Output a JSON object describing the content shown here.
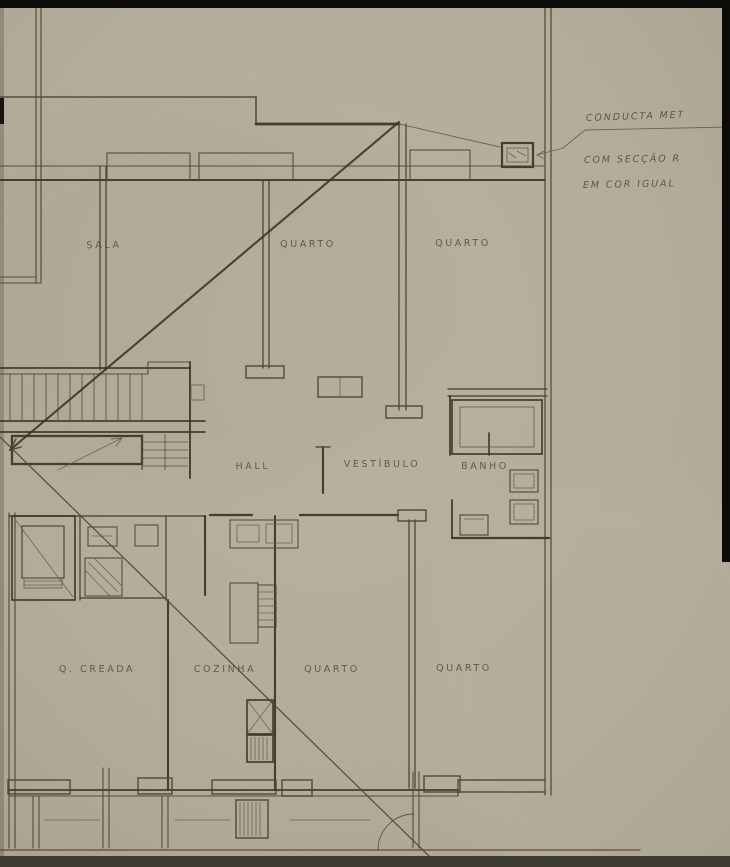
{
  "drawing": {
    "type": "architectural-floor-plan",
    "palette": {
      "paper": "#b2ab99",
      "paper_light": "#b9b2a1",
      "ink_dark": "#41331f",
      "ink": "#55452e",
      "ink_light": "#6d5b42",
      "edge_black": "#0c0b09",
      "bottom_bar": "#3f3c36"
    },
    "rooms": [
      {
        "label": "SALA",
        "x": 104,
        "y": 248,
        "r": -1
      },
      {
        "label": "QUARTO",
        "x": 308,
        "y": 247,
        "r": 0
      },
      {
        "label": "QUARTO",
        "x": 463,
        "y": 246,
        "r": 0
      },
      {
        "label": "HALL",
        "x": 253,
        "y": 469,
        "r": -1
      },
      {
        "label": "VESTÍBULO",
        "x": 382,
        "y": 467,
        "r": 0
      },
      {
        "label": "BANHO",
        "x": 485,
        "y": 469,
        "r": 0
      },
      {
        "label": "Q. CREADA",
        "x": 97,
        "y": 672,
        "r": 0
      },
      {
        "label": "COZINHA",
        "x": 225,
        "y": 672,
        "r": 0
      },
      {
        "label": "QUARTO",
        "x": 332,
        "y": 672,
        "r": 0
      },
      {
        "label": "QUARTO",
        "x": 464,
        "y": 671,
        "r": 0
      }
    ],
    "annotations": [
      {
        "text": "CONDUCTA MET",
        "x": 586,
        "y": 121,
        "r": -2
      },
      {
        "text": "COM SECÇÃO R",
        "x": 584,
        "y": 163,
        "r": -1
      },
      {
        "text": "EM COR IGUAL",
        "x": 583,
        "y": 188,
        "r": -1
      }
    ],
    "geometry": {
      "walls": [
        [
          36,
          8,
          36,
          283,
          1.2
        ],
        [
          41,
          8,
          41,
          283,
          1.2
        ],
        [
          0,
          97,
          256,
          97,
          1.6
        ],
        [
          256,
          97,
          256,
          124,
          1.6
        ],
        [
          256,
          124,
          399,
          124,
          2.8
        ],
        [
          0,
          166,
          545,
          166,
          1.1
        ],
        [
          0,
          180,
          545,
          180,
          1.9
        ],
        [
          399,
          124,
          399,
          410,
          1.4
        ],
        [
          406,
          124,
          406,
          410,
          1.4
        ],
        [
          263,
          180,
          263,
          368,
          1.4
        ],
        [
          269,
          180,
          269,
          368,
          1.4
        ],
        [
          545,
          8,
          545,
          795,
          1.3
        ],
        [
          551,
          8,
          551,
          795,
          1.3
        ],
        [
          0,
          277,
          36,
          277,
          1.1
        ],
        [
          0,
          283,
          41,
          283,
          1.1
        ],
        [
          100,
          166,
          100,
          370,
          1.4
        ],
        [
          106,
          166,
          106,
          370,
          1.4
        ],
        [
          0,
          368,
          190,
          368,
          1.7
        ],
        [
          0,
          374,
          148,
          374,
          1.1
        ],
        [
          148,
          374,
          148,
          362,
          1.1
        ],
        [
          148,
          362,
          190,
          362,
          1.1
        ],
        [
          190,
          362,
          190,
          478,
          1.9
        ],
        [
          0,
          421,
          205,
          421,
          1.7
        ],
        [
          0,
          432,
          205,
          432,
          1.7
        ],
        [
          210,
          515,
          252,
          515,
          2.3
        ],
        [
          300,
          515,
          398,
          515,
          2.3
        ],
        [
          448,
          389,
          547,
          389,
          1.4
        ],
        [
          448,
          396,
          547,
          396,
          1.4
        ],
        [
          450,
          396,
          450,
          455,
          1.8
        ],
        [
          452,
          500,
          452,
          538,
          1.8
        ],
        [
          452,
          538,
          549,
          538,
          2.2
        ],
        [
          489,
          433,
          489,
          455,
          1.7
        ],
        [
          323,
          447,
          323,
          493,
          2.1
        ],
        [
          316,
          447,
          330,
          447,
          1.4
        ],
        [
          9,
          513,
          9,
          848,
          1.2
        ],
        [
          15,
          513,
          15,
          848,
          1.2
        ],
        [
          9,
          516,
          205,
          516,
          1.6
        ],
        [
          80,
          516,
          80,
          600,
          1.4
        ],
        [
          166,
          516,
          166,
          600,
          1.4
        ],
        [
          80,
          598,
          166,
          598,
          1.4
        ],
        [
          205,
          516,
          205,
          595,
          2.1
        ],
        [
          168,
          600,
          168,
          790,
          2.1
        ],
        [
          275,
          516,
          275,
          790,
          2.1
        ],
        [
          409,
          520,
          409,
          788,
          1.4
        ],
        [
          415,
          520,
          415,
          788,
          1.4
        ],
        [
          458,
          780,
          545,
          780,
          1.4
        ],
        [
          458,
          792,
          545,
          792,
          1.4
        ],
        [
          458,
          780,
          458,
          795,
          1.4
        ],
        [
          9,
          790,
          458,
          790,
          1.7
        ],
        [
          9,
          796,
          458,
          796,
          1.1
        ],
        [
          0,
          850,
          640,
          850,
          1.3
        ],
        [
          103,
          768,
          103,
          848,
          1.1
        ],
        [
          109,
          768,
          109,
          848,
          1.1
        ],
        [
          162,
          796,
          162,
          848,
          1.1
        ],
        [
          168,
          796,
          168,
          848,
          1.1
        ],
        [
          413,
          772,
          413,
          848,
          1.1
        ],
        [
          419,
          772,
          419,
          848,
          1.1
        ],
        [
          33,
          796,
          33,
          848,
          1.1
        ],
        [
          39,
          796,
          39,
          848,
          1.1
        ],
        [
          45,
          820,
          100,
          820,
          0.8
        ],
        [
          175,
          820,
          230,
          820,
          0.8
        ],
        [
          290,
          820,
          370,
          820,
          0.8
        ],
        [
          399,
          124,
          500,
          147,
          0.9
        ]
      ],
      "rects": [
        {
          "x": 107,
          "y": 153,
          "w": 83,
          "h": 27,
          "sw": 1.1,
          "n": "window-bay"
        },
        {
          "x": 199,
          "y": 153,
          "w": 94,
          "h": 27,
          "sw": 1.1,
          "n": "window-bay"
        },
        {
          "x": 410,
          "y": 150,
          "w": 60,
          "h": 30,
          "sw": 1.1,
          "n": "window-bay"
        },
        {
          "x": 502,
          "y": 143,
          "w": 31,
          "h": 24,
          "sw": 2.2,
          "n": "duct-symbol"
        },
        {
          "x": 507,
          "y": 148,
          "w": 21,
          "h": 14,
          "sw": 0.9,
          "n": "duct-symbol-inner"
        },
        {
          "x": 246,
          "y": 366,
          "w": 38,
          "h": 12,
          "sw": 1.5,
          "n": "wall-end-cap"
        },
        {
          "x": 386,
          "y": 406,
          "w": 36,
          "h": 12,
          "sw": 1.5,
          "n": "wall-end-cap"
        },
        {
          "x": 398,
          "y": 510,
          "w": 28,
          "h": 11,
          "sw": 1.5,
          "n": "wall-end-cap"
        },
        {
          "x": 318,
          "y": 377,
          "w": 44,
          "h": 20,
          "sw": 1.5,
          "n": "hall-window"
        },
        {
          "x": 12,
          "y": 436,
          "w": 130,
          "h": 28,
          "sw": 2.3,
          "n": "stair-landing"
        },
        {
          "x": 12,
          "y": 516,
          "w": 63,
          "h": 84,
          "sw": 1.7,
          "n": "elevator-shaft"
        },
        {
          "x": 22,
          "y": 526,
          "w": 42,
          "h": 52,
          "sw": 1.3,
          "n": "elevator-car"
        },
        {
          "x": 24,
          "y": 578,
          "w": 38,
          "h": 10,
          "sw": 0.9,
          "n": "elevator-sill"
        },
        {
          "x": 88,
          "y": 527,
          "w": 29,
          "h": 19,
          "sw": 1.1,
          "n": "bath-fixture"
        },
        {
          "x": 135,
          "y": 525,
          "w": 23,
          "h": 21,
          "sw": 1.1,
          "n": "bath-fixture"
        },
        {
          "x": 85,
          "y": 558,
          "w": 37,
          "h": 38,
          "sw": 1.1,
          "n": "shower-tray"
        },
        {
          "x": 230,
          "y": 520,
          "w": 68,
          "h": 28,
          "sw": 1.1,
          "n": "kitchen-counter"
        },
        {
          "x": 237,
          "y": 525,
          "w": 22,
          "h": 17,
          "sw": 0.8,
          "n": "kitchen-sink"
        },
        {
          "x": 266,
          "y": 524,
          "w": 26,
          "h": 19,
          "sw": 0.8,
          "n": "kitchen-sink"
        },
        {
          "x": 230,
          "y": 583,
          "w": 28,
          "h": 60,
          "sw": 1.1,
          "n": "kitchen-cabinet"
        },
        {
          "x": 258,
          "y": 585,
          "w": 18,
          "h": 42,
          "sw": 1.1,
          "n": "kitchen-shelves"
        },
        {
          "x": 247,
          "y": 700,
          "w": 26,
          "h": 34,
          "sw": 1.7,
          "n": "dumbwaiter"
        },
        {
          "x": 247,
          "y": 735,
          "w": 26,
          "h": 27,
          "sw": 1.7,
          "n": "flue-hatch"
        },
        {
          "x": 236,
          "y": 800,
          "w": 32,
          "h": 38,
          "sw": 1.5,
          "n": "flue-hatch"
        },
        {
          "x": 452,
          "y": 400,
          "w": 90,
          "h": 54,
          "sw": 1.7,
          "n": "bathtub"
        },
        {
          "x": 460,
          "y": 407,
          "w": 74,
          "h": 40,
          "sw": 0.9,
          "n": "bathtub-inner"
        },
        {
          "x": 510,
          "y": 470,
          "w": 28,
          "h": 22,
          "sw": 1.2,
          "n": "toilet"
        },
        {
          "x": 514,
          "y": 474,
          "w": 20,
          "h": 14,
          "sw": 0.8,
          "n": "toilet-inner"
        },
        {
          "x": 510,
          "y": 500,
          "w": 28,
          "h": 24,
          "sw": 1.2,
          "n": "bidet"
        },
        {
          "x": 514,
          "y": 504,
          "w": 20,
          "h": 16,
          "sw": 0.8,
          "n": "bidet-inner"
        },
        {
          "x": 460,
          "y": 515,
          "w": 28,
          "h": 20,
          "sw": 1.2,
          "n": "washbasin"
        },
        {
          "x": 191,
          "y": 385,
          "w": 13,
          "h": 15,
          "sw": 0.9,
          "n": "stair-door-notch"
        },
        {
          "x": 8,
          "y": 780,
          "w": 62,
          "h": 14,
          "sw": 1.5,
          "n": "pilaster"
        },
        {
          "x": 138,
          "y": 778,
          "w": 34,
          "h": 16,
          "sw": 1.5,
          "n": "pilaster"
        },
        {
          "x": 212,
          "y": 780,
          "w": 64,
          "h": 14,
          "sw": 1.5,
          "n": "pilaster"
        },
        {
          "x": 282,
          "y": 780,
          "w": 30,
          "h": 16,
          "sw": 1.5,
          "n": "pilaster"
        },
        {
          "x": 424,
          "y": 776,
          "w": 36,
          "h": 16,
          "sw": 1.5,
          "n": "pilaster"
        }
      ],
      "details": [
        [
          509,
          153,
          516,
          158
        ],
        [
          517,
          151,
          526,
          156
        ],
        [
          24,
          581,
          62,
          581
        ],
        [
          24,
          585,
          62,
          585
        ],
        [
          88,
          562,
          118,
          592
        ],
        [
          94,
          558,
          122,
          586
        ],
        [
          85,
          570,
          110,
          596
        ],
        [
          92,
          536,
          113,
          536
        ],
        [
          258,
          592,
          276,
          592
        ],
        [
          258,
          599,
          276,
          599
        ],
        [
          258,
          606,
          276,
          606
        ],
        [
          258,
          613,
          276,
          613
        ],
        [
          258,
          620,
          276,
          620
        ],
        [
          247,
          700,
          273,
          734
        ],
        [
          273,
          700,
          247,
          734
        ],
        [
          251,
          737,
          251,
          760
        ],
        [
          255,
          737,
          255,
          760
        ],
        [
          259,
          737,
          259,
          760
        ],
        [
          263,
          737,
          263,
          760
        ],
        [
          267,
          737,
          267,
          760
        ],
        [
          240,
          802,
          240,
          836
        ],
        [
          244,
          802,
          244,
          836
        ],
        [
          248,
          802,
          248,
          836
        ],
        [
          252,
          802,
          252,
          836
        ],
        [
          256,
          802,
          256,
          836
        ],
        [
          260,
          802,
          260,
          836
        ],
        [
          464,
          519,
          484,
          519
        ],
        [
          340,
          377,
          340,
          397
        ],
        [
          14,
          518,
          73,
          597
        ]
      ],
      "stairs": {
        "tread_x_start": 10,
        "tread_x_end": 142,
        "tread_step": 12,
        "tread_y_top": 374,
        "tread_y_bottom": 420,
        "return_treads_y": [
          442,
          450,
          458,
          466
        ],
        "return_x_start": 142,
        "return_x_end": 188,
        "return_verticals": [
          [
            142,
            434,
            142,
            470,
            1.3
          ],
          [
            165,
            434,
            165,
            470,
            0.85
          ]
        ]
      },
      "polylines": [
        {
          "pts": [
            [
              399,
              122
            ],
            [
              10,
              450
            ]
          ],
          "w": 2.1,
          "n": "plan-diagonal"
        },
        {
          "pts": [
            [
              0,
              437
            ],
            [
              430,
              857
            ]
          ],
          "w": 1.3,
          "n": "plan-diagonal"
        },
        {
          "pts": [
            [
              58,
              470
            ],
            [
              122,
              438
            ]
          ],
          "w": 0.9,
          "n": "stair-direction-arrow"
        },
        {
          "pts": [
            [
              21,
              447
            ],
            [
              10,
              450
            ],
            [
              16,
              439
            ]
          ],
          "w": 1.6,
          "n": "arrowhead"
        },
        {
          "pts": [
            [
              111,
              439
            ],
            [
              122,
              438
            ],
            [
              116,
              446
            ]
          ],
          "w": 0.9,
          "n": "arrowhead"
        },
        {
          "pts": [
            [
              537,
              155
            ],
            [
              563,
              148
            ],
            [
              585,
              130
            ],
            [
              729,
              127
            ]
          ],
          "w": 0.9,
          "n": "annotation-leader"
        },
        {
          "pts": [
            [
              544,
              151
            ],
            [
              537,
              155
            ],
            [
              545,
              159
            ]
          ],
          "w": 0.9,
          "n": "annotation-leader-arrow"
        }
      ],
      "paths": [
        {
          "d": "M 378 850 A 36 36 0 0 1 414 814",
          "w": 0.9,
          "n": "door-swing-arc"
        }
      ],
      "scan_edges": {
        "top": {
          "x": 0,
          "y": 0,
          "w": 730,
          "h": 8
        },
        "right": {
          "x": 722,
          "y": 0,
          "w": 8,
          "h": 562
        },
        "bottom": {
          "x": 0,
          "y": 856,
          "w": 730,
          "h": 11
        },
        "left_notch": {
          "x": 0,
          "y": 98,
          "w": 4,
          "h": 26
        }
      }
    }
  }
}
